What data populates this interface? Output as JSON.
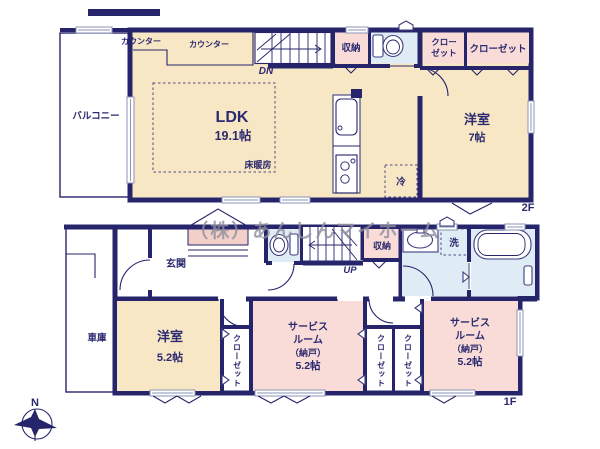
{
  "watermark": "（株）あんしんマイホーム",
  "compass": {
    "north": "N"
  },
  "colors": {
    "wall": "#26246a",
    "room_cream": "#f8e7c5",
    "room_pink": "#f9dcd7",
    "room_blue": "#dfebf5",
    "porch_pink": "#f2cfc9",
    "label_text": "#2b2a70",
    "watermark_gray": "#8f8f9e"
  },
  "floor2": {
    "label": "2F",
    "balcony": "バルコニー",
    "counter_a": "カウンター",
    "counter_b": "カウンター",
    "stairs_down": "DN",
    "storage": "収納",
    "closet_a_line1": "クロー",
    "closet_a_line2": "ゼット",
    "closet_b": "クローゼット",
    "ldk": "LDK",
    "ldk_size": "19.1帖",
    "floor_heating": "床暖房",
    "fridge": "冷",
    "bedroom": "洋室",
    "bedroom_size": "7帖"
  },
  "floor1": {
    "label": "1F",
    "entrance": "玄関",
    "garage": "車庫",
    "stairs_up": "UP",
    "storage": "収納",
    "laundry": "洗",
    "bedroom": "洋室",
    "bedroom_size": "5.2帖",
    "closet": "クローゼット",
    "service_line1": "サービス",
    "service_line2": "ルーム",
    "service_line3": "（納戸）",
    "service_line4": "5.2帖"
  }
}
